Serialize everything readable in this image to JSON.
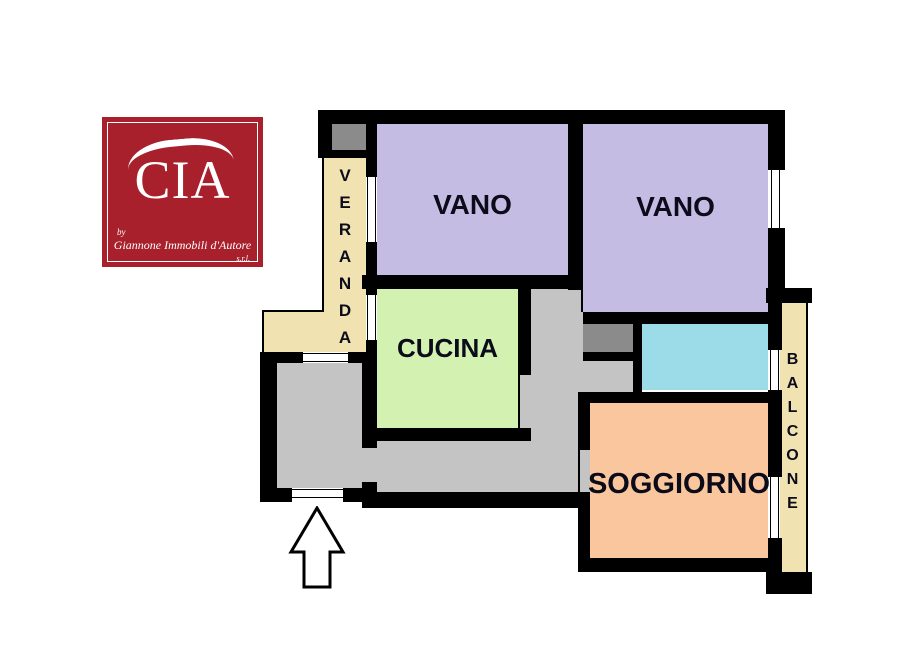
{
  "logo": {
    "monogram": "CIA",
    "by": "by",
    "name": "Giannone Immobili d'Autore",
    "suffix": "s.r.l.",
    "bg": "#A7202B",
    "fg": "#FFFFFF"
  },
  "plan": {
    "vano_left": {
      "label": "VANO",
      "color": "#C5BCE4"
    },
    "vano_right": {
      "label": "VANO",
      "color": "#C5BCE4"
    },
    "cucina": {
      "label": "CUCINA",
      "color": "#D3F1B1"
    },
    "soggiorno": {
      "label": "SOGGIORNO",
      "color": "#F9C69E"
    },
    "veranda": {
      "label": "VERANDA",
      "color": "#F0E3B1"
    },
    "balcone": {
      "label": "BALCONE",
      "color": "#F0E3B1"
    },
    "bagno": {
      "color": "#9CDCE8"
    },
    "corridoio": {
      "color": "#C4C4C4"
    },
    "ingresso": {
      "color": "#C4C4C4"
    }
  },
  "palette": {
    "wall": "#000000",
    "fixture_gray": "#8B8B8B",
    "label_text": "#0B0B1A",
    "background": "#FFFFFF"
  }
}
